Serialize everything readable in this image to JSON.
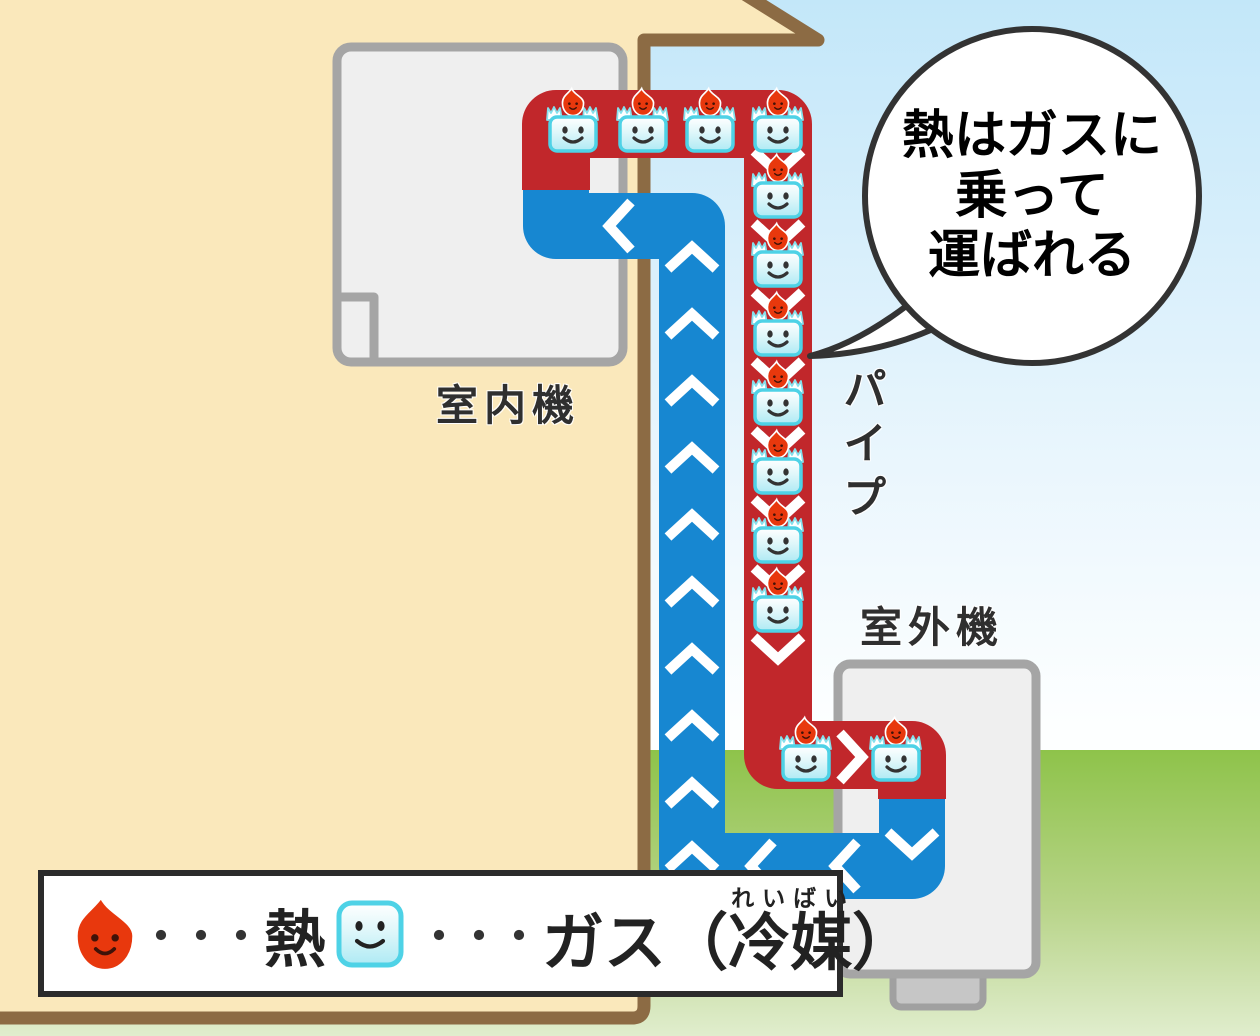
{
  "labels": {
    "indoor_unit": "室内機",
    "outdoor_unit": "室外機",
    "pipe": "パイプ"
  },
  "speech_bubble": {
    "lines": [
      "熱はガスに",
      "乗って",
      "運ばれる"
    ]
  },
  "legend": {
    "dots": "・・・",
    "heat_label": "熱",
    "gas_prefix": "ガス（",
    "gas_word": "冷媒",
    "gas_furigana": "れいばい",
    "gas_suffix": "）"
  },
  "figures": {
    "gas_characters_on_top_heat_pipe": 4,
    "gas_characters_on_down_heat_pipe": 7,
    "gas_characters_near_outdoor_unit": 2,
    "down_arrows_on_heat_pipe": 8,
    "right_arrow_on_heat_pipe": 1,
    "up_arrows_on_gas_pipe": 10,
    "left_arrows_on_gas_pipe": 3,
    "down_arrow_on_gas_pipe": 1
  },
  "colors": {
    "heat_pipe": "#c1272b",
    "gas_pipe": "#1787d1",
    "wall": "#fae8bb",
    "wall_border": "#8c6b44",
    "grass_top": "#8ec34a",
    "grass_bottom": "#e0edcd",
    "sky_top": "#c3e7f9",
    "unit_fill": "#efefef",
    "unit_border": "#a5a5a5",
    "character_cyan": "#4ed2e6",
    "flame_red": "#e8380d",
    "label_color": "#2f2f2f",
    "legend_border": "#2b2b2b",
    "bubble_border": "#333333"
  }
}
